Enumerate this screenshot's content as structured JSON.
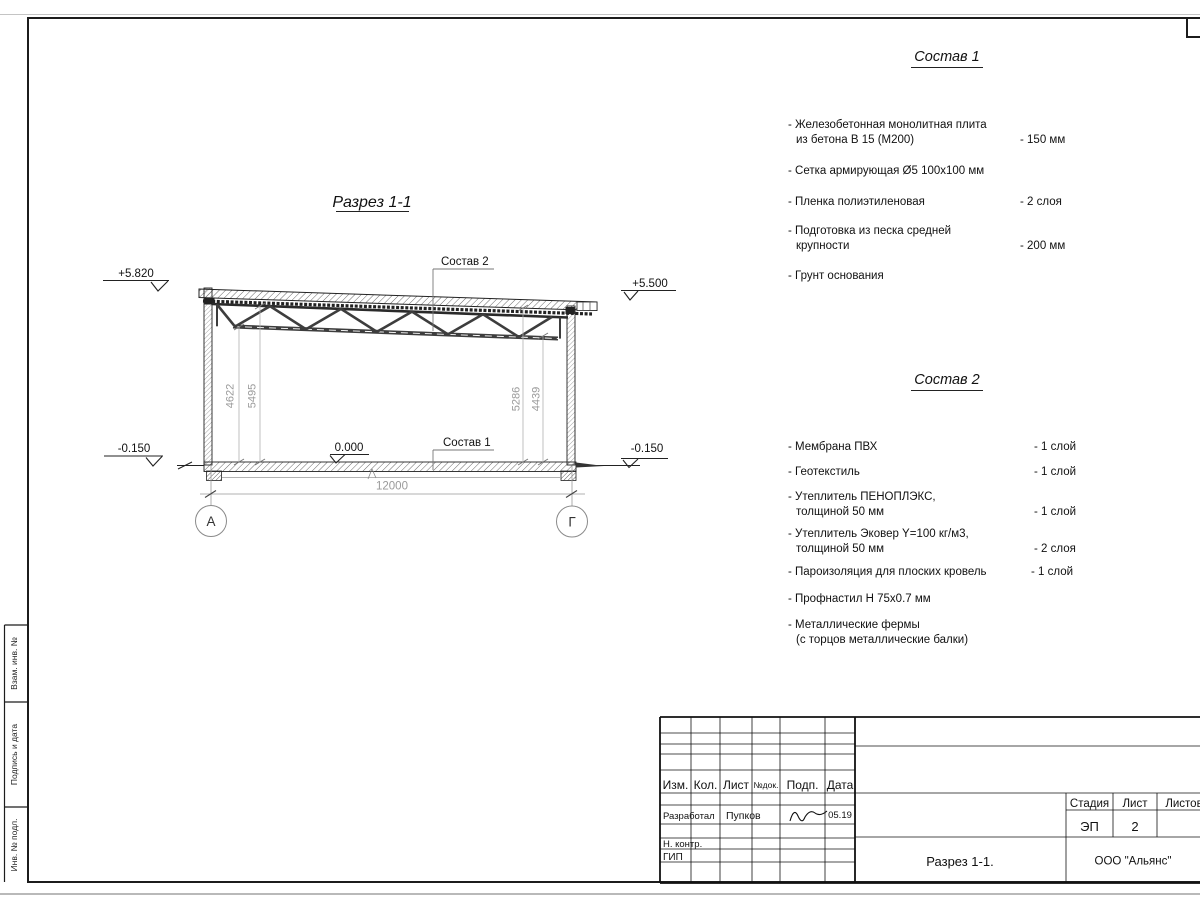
{
  "section": {
    "title": "Разрез 1-1",
    "leader_sostav2": "Состав 2",
    "leader_sostav1": "Состав 1",
    "elevations": {
      "top_left": "+5.820",
      "top_right": "+5.500",
      "zero": "0.000",
      "ground_left": "-0.150",
      "ground_right": "-0.150"
    },
    "dimensions": {
      "span": "12000",
      "left_inner": "4622",
      "left_outer": "5495",
      "right_inner": "5286",
      "right_outer": "4439"
    },
    "grid": {
      "left": "А",
      "right": "Г"
    }
  },
  "sostav1": {
    "heading": "Состав 1",
    "items": [
      {
        "name": "- Железобетонная  монолитная плита",
        "name2": "из бетона В 15 (М200)",
        "value": "- 150 мм"
      },
      {
        "name": "- Сетка армирующая Ø5 100х100 мм",
        "value": ""
      },
      {
        "name": "- Пленка полиэтиленовая",
        "value": "-  2 слоя"
      },
      {
        "name": "- Подготовка из песка средней",
        "name2": "крупности",
        "value": "- 200 мм"
      },
      {
        "name": "- Грунт основания",
        "value": ""
      }
    ]
  },
  "sostav2": {
    "heading": "Состав 2",
    "items": [
      {
        "name": "- Мембрана ПВХ",
        "value": "- 1 слой"
      },
      {
        "name": "- Геотекстиль",
        "value": "- 1 слой"
      },
      {
        "name": "- Утеплитель ПЕНОПЛЭКС,",
        "name2": "толщиной 50 мм",
        "value": "- 1 слой"
      },
      {
        "name": "- Утеплитель Эковер Y=100 кг/м3,",
        "name2": "толщиной 50 мм",
        "value": "- 2 слоя"
      },
      {
        "name": "- Пароизоляция для плоских кровель",
        "value": "- 1 слой"
      },
      {
        "name": "- Профнастил Н 75х0.7 мм",
        "value": ""
      },
      {
        "name": "- Металлические фермы",
        "name2": "(с торцов металлические балки)",
        "value": ""
      }
    ]
  },
  "titleblock": {
    "cols": {
      "izm": "Изм.",
      "kol": "Кол.",
      "list": "Лист",
      "ndok": "№док.",
      "podp": "Подп.",
      "data": "Дата"
    },
    "developed_label": "Разработал",
    "developed_name": "Пупков",
    "developed_date": "05.19",
    "ncontr_label": "Н. контр.",
    "gip_label": "ГИП",
    "stage_label": "Стадия",
    "sheet_label": "Лист",
    "sheets_label": "Листов",
    "stage_value": "ЭП",
    "sheet_value": "2",
    "doc_title": "Разрез 1-1.",
    "company": "ООО \"Альянс\""
  },
  "margin": {
    "vzam": "Взам. инв. №",
    "podp_data": "Подпись и дата",
    "inv_podl": "Инв. № подл."
  }
}
